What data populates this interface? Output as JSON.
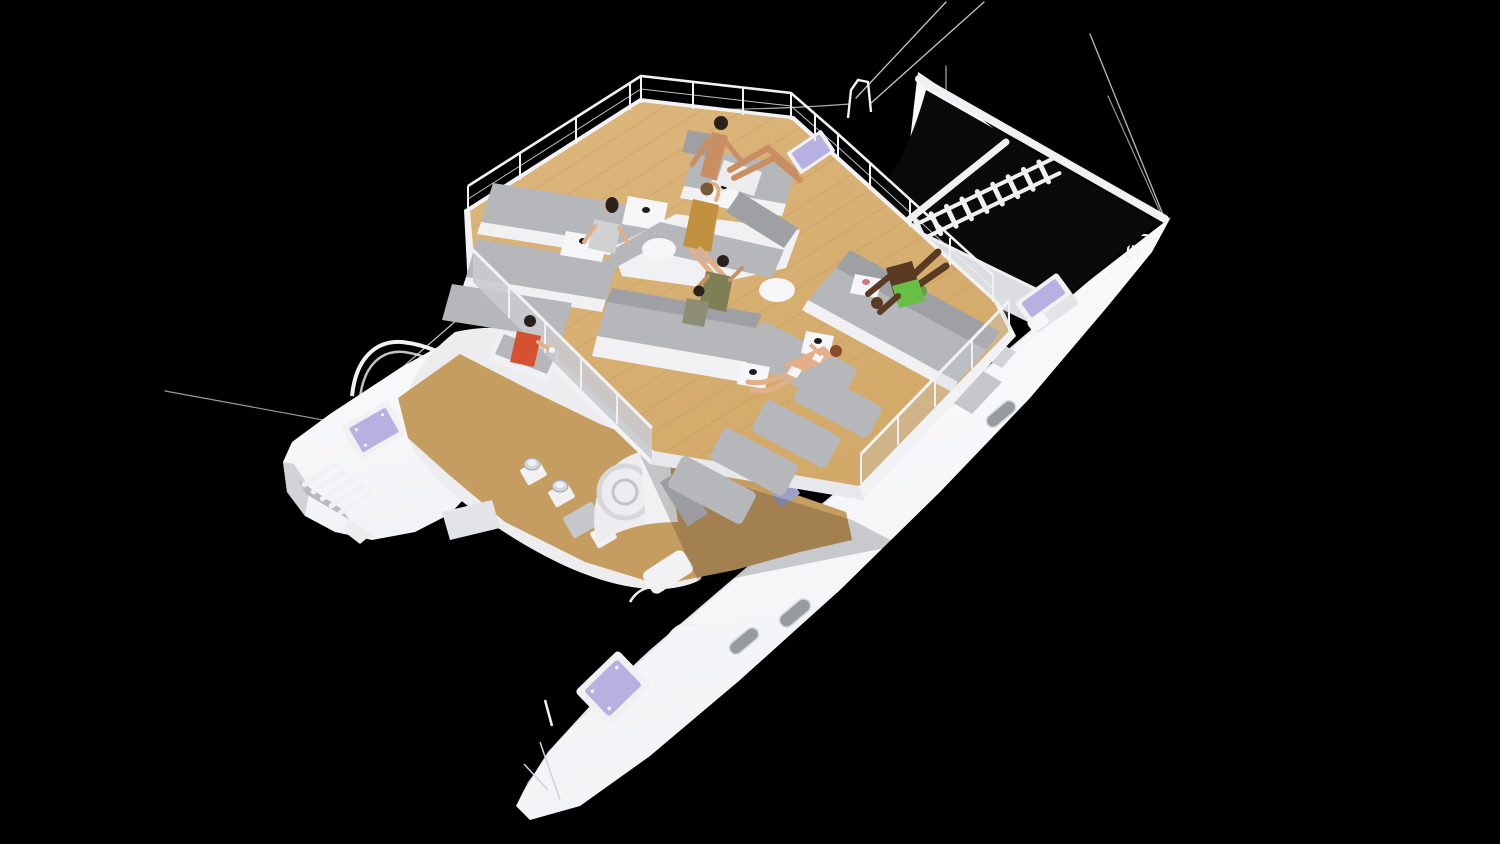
{
  "scene": {
    "title": "3D rendering of a luxury sailing catamaran with flybridge lounge deck",
    "view": "aerial three-quarter view on black background",
    "background_color": "#000000"
  },
  "colors": {
    "background": "#000000",
    "hull_white": "#f2f3f6",
    "hull_bright": "#fbfbfd",
    "hull_deck": "#e3e4e8",
    "hull_edge": "#d2d3d8",
    "superstructure": "#ededf0",
    "walkway_gray": "#dcdde1",
    "deck_wood": "#d2a968",
    "deck_wood_light": "#ddb77e",
    "lower_deck_wood": "#c69d61",
    "plank_line": "#b9905a",
    "fascia_white": "#f2f2f5",
    "fascia_edge": "#e7e8ec",
    "cushion_light": "#b5b7ba",
    "cushion_mid": "#9ea0a3",
    "cushion_dark": "#8f9194",
    "sofa_base": "#f1f1f4",
    "railing_white": "#f1f2f4",
    "wire_gray": "#d8d9dd",
    "glass_panel": "rgba(205,210,220,0.28)",
    "balustrade_gray": "#c9cace",
    "net_black": "#0a0a0b",
    "beam_white": "#eff0f2",
    "hatch_lavender": "#b6b1e0",
    "hatch_frame": "#f1f1f4",
    "hatch_small": "#9aa0c8",
    "window_silver": "#969aa1",
    "window_rim": "#d6d8db",
    "table_white": "#f6f6f8",
    "cup_black": "#1d1d1f",
    "cup_pink": "#d87680",
    "cup_white": "#f6f6f8",
    "metal_silver": "#d4d6da",
    "metal_dark": "#9ea0a5",
    "equipment_gray": "#bfc0c5",
    "box_gray": "#c6c7cb",
    "pillow_tan": "#c5a176",
    "pillow_brown": "#8b5e3c",
    "plant_green_dark": "#4f7a36",
    "plant_green": "#6b9c4a",
    "skin_light": "#e2af88",
    "skin_tan": "#c98e62",
    "skin_dark": "#5b3a24",
    "hair_dark": "#2b211a",
    "hair_brown": "#7a5a36",
    "hair_auburn": "#8a4a2c",
    "shirt_olive": "#7e7f55",
    "top_olive_gray": "#8d8d76",
    "top_red": "#d5512f",
    "top_gray": "#cfd1d2",
    "shorts_green": "#67bf45",
    "white_fabric": "#ededee",
    "dress_mustard": "#c2913f",
    "shadow": "rgba(0,0,0,0.18)"
  },
  "boat": {
    "type": "twin-hull sailing catamaran",
    "decks": [
      "flybridge lounge deck with teak flooring and gray lounge sofas",
      "lower main deck with teak floor, winches and support pylon",
      "bow area with black trampoline nets and boarding ladder"
    ],
    "features": [
      "bow trampoline nets between hulls",
      "white boarding ladder across the net",
      "lavender skylight hatches",
      "oval portlight windows on hull side",
      "bow pulpits and rigging stays",
      "stern swim steps on port hull",
      "three deck winches",
      "glass and panel balustrades",
      "round white cocktail tables",
      "cube side tables with cups",
      "green potted plant",
      "scatter pillows on starboard bench"
    ]
  },
  "people": [
    {
      "id": "man-shirtless",
      "pose": "reclining on forward lounger",
      "wearing": "white shorts / towel"
    },
    {
      "id": "woman-gray-top",
      "pose": "seated on forward lounger",
      "wearing": "light gray top"
    },
    {
      "id": "woman-mustard-dress",
      "pose": "seated on center chaise, hand to head",
      "wearing": "mustard dress"
    },
    {
      "id": "man-olive-shirt",
      "pose": "seated on center sofa",
      "wearing": "olive shirt"
    },
    {
      "id": "woman-dark-hair",
      "pose": "seated beside olive-shirt man",
      "wearing": "olive-gray top"
    },
    {
      "id": "man-green-shorts",
      "pose": "lounging on starboard corner sofa, legs up",
      "wearing": "green shorts"
    },
    {
      "id": "woman-bikini",
      "pose": "reclining on sun pad holding a drink",
      "wearing": "white bikini"
    },
    {
      "id": "woman-red-top",
      "pose": "seated on port-side bench holding a cup",
      "wearing": "red top"
    }
  ]
}
